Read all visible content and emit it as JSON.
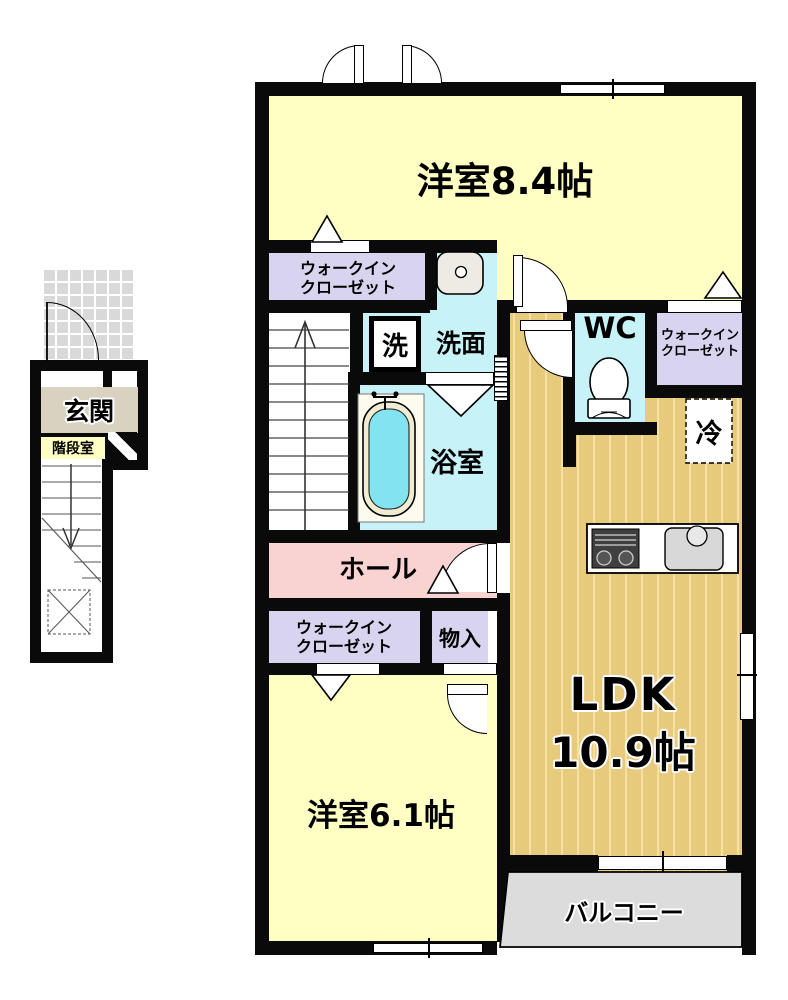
{
  "rooms": {
    "bedroom84": {
      "label": "洋室8.4帖"
    },
    "wic_top": {
      "line1": "ウォークイン",
      "line2": "クローゼット"
    },
    "laundry": {
      "label": "洗"
    },
    "washroom": {
      "label": "洗面"
    },
    "bathroom": {
      "label": "浴室"
    },
    "wc": {
      "label": "WC"
    },
    "wic_right": {
      "line1": "ウォークイン",
      "line2": "クローゼット"
    },
    "refrigerator": {
      "label": "冷"
    },
    "hall": {
      "label": "ホール"
    },
    "wic_lower": {
      "line1": "ウォークイン",
      "line2": "クローゼット"
    },
    "storage": {
      "label": "物入"
    },
    "ldk": {
      "label": "LDK",
      "size": "10.9帖"
    },
    "bedroom61": {
      "label": "洋室6.1帖"
    },
    "balcony": {
      "label": "バルコニー"
    },
    "entrance": {
      "label": "玄関"
    },
    "stairwell": {
      "label": "階段室"
    }
  },
  "colors": {
    "room_yellow": "#FFFFC4",
    "closet_purple": "#D8D4EF",
    "wet_cyan": "#C7F2F8",
    "bath_water": "#82E4EE",
    "ldk_wood": "#E8CA7C",
    "hall_pink": "#F9D2D2",
    "entrance_beige": "#D9D2C0",
    "balcony_gray": "#DCDCDC",
    "wall": "#0A0A0A"
  }
}
